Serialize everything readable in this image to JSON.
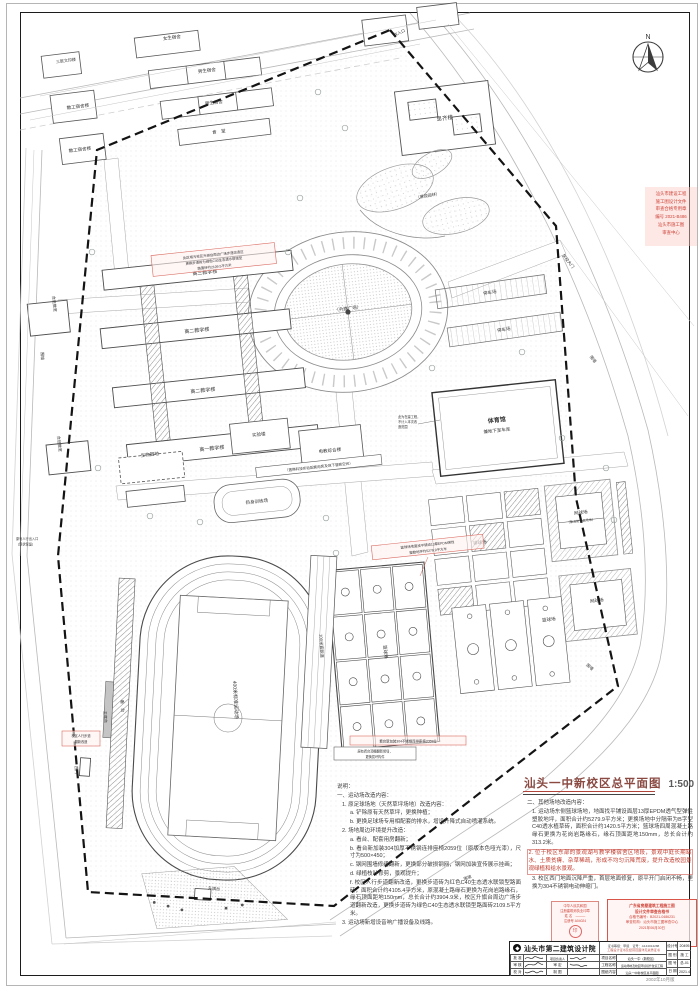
{
  "title": {
    "text": "汕头一中新校区总平面图",
    "scale": "1:500"
  },
  "north": {
    "label": "N"
  },
  "page": {
    "edition": "2002年10月版"
  },
  "notes_left": {
    "items": [
      "说明：",
      "一、运动场改造内容：",
      "1. 原足球场地（天然草坪场地）改造内容：",
      "a. 铲除原有天然草坪，更换种植；",
      "b. 更换足球场专用相配套的排水，增设升降式自动喷灌系统。",
      "2. 场地周边环境提升改造：",
      "a. 看台、配套用房翻新；",
      "b. 看台新加装304加厚不锈钢连排座椅2059位（原版本色哑光漆），尺寸为500×450；",
      "c. 钢网围墙修缮翻新，更换部分破损钢网，钢网加装宣传展示挂画；",
      "d. 绿植枝叶修剪，景观提升；",
      "f. 校区人行步道翻新改造，更换步道砖为红色C40生态透水联锁型路面砖，面积合计约4105.4平方米，原混凝土路缘石更换为花岗岩路缘石，缘石顶面距地150mm，总长合计约3904.9米，校区升旗台周边广场步道翻新改造，更换步道砖为绿色C40生态透水联锁型路面砖2109.5平方米。",
      "3. 运动场新增设音响广播设备及线路。"
    ]
  },
  "notes_right": {
    "items": [
      "二、其他场地改造内容：",
      "1. 运动场东侧篮球场地，地面找平铺设面层13厚EPDM透气型弹性塑胶地坪，面积合计约5279.9平方米；更换场地中分隔带为B字型C40透水植草砖，面积合计约1420.5平方米；篮球场四周混凝土路缘石更换为花岗岩路缘石，缘石顶面距地150mm，总长合计约313.2米。",
      "2. 位于校区东部的景观湖与教学楼宿舍区地段，景观中庭长期缺水、土质贫瘠、杂草稀疏，形成不均匀沉降荒废，提升改造校园景观绿植和给水景观。",
      "3. 校区西门地面沉降严重，首层地面修复，原平开门启闭不畅，更换为304不锈钢电动伸缩门。"
    ]
  },
  "plan": {
    "labels": [
      {
        "text": "教工宿舍楼"
      },
      {
        "text": "教工宿舍楼"
      },
      {
        "text": "三层文印楼"
      },
      {
        "text": "女生宿舍"
      },
      {
        "text": "男生宿舍"
      },
      {
        "text": "男生宿舍"
      },
      {
        "text": "食　堂"
      },
      {
        "text": "思齐楼"
      },
      {
        "text": "合班教室"
      },
      {
        "text": "合班教室"
      },
      {
        "text": "高三教学楼"
      },
      {
        "text": "高二教学楼"
      },
      {
        "text": "高二教学楼"
      },
      {
        "text": "高一教学楼"
      },
      {
        "text": "（升旗广场）"
      },
      {
        "text": "停车场"
      },
      {
        "text": "停车场"
      },
      {
        "text": "体育馆"
      },
      {
        "text": "兼地下室车库"
      },
      {
        "text": "实验楼"
      },
      {
        "text": "电教综合楼"
      },
      {
        "text": "生物园地"
      },
      {
        "text": "热身训练场"
      },
      {
        "text": "排球场"
      },
      {
        "text": "网球场"
      },
      {
        "text": "（兼消防登高场地）"
      },
      {
        "text": "网球场"
      },
      {
        "text": "篮球场"
      },
      {
        "text": "篮球场"
      },
      {
        "text": "400米标准运动场"
      },
      {
        "text": "100米直跑道"
      },
      {
        "text": "看　台"
      },
      {
        "text": "主席台"
      },
      {
        "text": "升旗台"
      },
      {
        "text": "围墙"
      },
      {
        "text": "围墙"
      },
      {
        "text": "围墙"
      },
      {
        "text": "围墙"
      },
      {
        "text": "学校大门"
      },
      {
        "text": "次入口"
      },
      {
        "text": "西门"
      },
      {
        "text": "（景观园林）"
      }
    ]
  },
  "annotations": {
    "red": [
      {
        "l0": "此区域为校区升旗台周边广场步道改造区",
        "l1": "更换步道砖为绿色C40生态透水联锁型",
        "l2": "路面砖约2109.5平方米"
      },
      {
        "l0": "篮球场地面找平铺设13厚EPDM弹性",
        "l1": "塑胶地坪约5279.9平方米"
      },
      {
        "l0": "看台新加装304不锈钢连排座椅2059位"
      },
      {
        "l0": "校区人行步道",
        "l1": "翻新改造"
      }
    ],
    "black": [
      {
        "l0": "（置换科技实验配套用房及地下管廊空间）"
      },
      {
        "l0": "此为在建工程，",
        "l1": "不计入本次改",
        "l2": "造范围"
      },
      {
        "l0": "原有看台顶棚翻新修缮，",
        "l1": "更换损坏构件"
      },
      {
        "l0": "原有人行出入口",
        "l1": "（现状保留）"
      }
    ]
  },
  "stamps": {
    "registration": {
      "lines": [
        "中华人民共和国",
        "注册建筑师执业印章",
        "姓 名　———",
        "注册号 A04024",
        "印"
      ]
    },
    "review": {
      "title1": "广东省房屋建筑工程施工图",
      "title2": "设计文件审查合格书",
      "lines": [
        "合格书编号：B2021-0486231",
        "审查机构：汕头市施工图审查中心",
        "2021年06月30日"
      ]
    },
    "side": {
      "lines": [
        "汕头市建设工程",
        "施工图设计文件",
        "审查合格专用章",
        "编号 2021-B486",
        "汕头市施工图",
        "审查中心"
      ]
    }
  },
  "titleblock": {
    "company": "汕头市第二建筑设计院",
    "cert1": "证书等级：甲级　证号：A144014288",
    "cert2": "工程设计证书及经营范围详见资质证书",
    "sig_rows": [
      {
        "l1": "批 准",
        "l2": "项目负责人"
      },
      {
        "l1": "审 核",
        "l2": "审 定"
      },
      {
        "l1": "校 对",
        "l2": "制 图"
      }
    ],
    "info_rows": [
      {
        "label": "项目名称",
        "value": "汕头一中（新校区）"
      },
      {
        "label": "工程名称",
        "value": "运动场地及校园环境提升改造工程"
      },
      {
        "label": "图纸内容",
        "value": "汕头一中新校区总平面图"
      }
    ],
    "meta_rows": [
      {
        "label": "设计号",
        "value": "20495"
      },
      {
        "label": "图 别",
        "value": "施 工"
      },
      {
        "label": "图 号",
        "value": "总-01"
      },
      {
        "label": "日 期",
        "value": "2021.4"
      }
    ]
  }
}
